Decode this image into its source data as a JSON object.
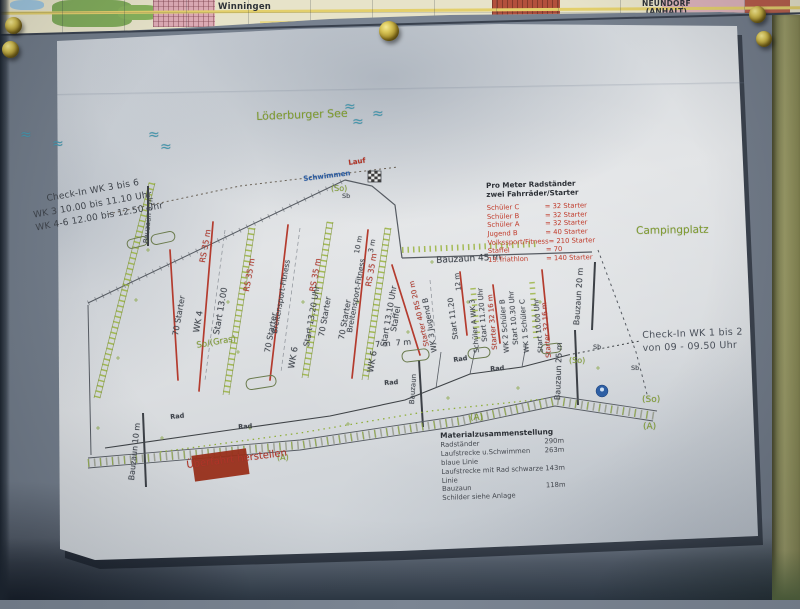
{
  "colors": {
    "dark": "#3f444b",
    "red": "#b23325",
    "green": "#7f9c2e",
    "blue": "#2e5fa4",
    "wave": "#4596ac",
    "paper": "#d6dade",
    "board": "#7b8593",
    "wood": "#9a9a66",
    "pin_gold": "#d8c456",
    "plan_line": "#565b62"
  },
  "background_map": {
    "town1": "Winningen",
    "town2_line1": "NEUNDORF",
    "town2_line2": "(ANHALT)"
  },
  "plan": {
    "checkin_left": [
      "Check-In WK 3 bis 6",
      "WK 3   10.00 bis 11.10 Uhr",
      "WK 4-6   12.00 bis 12.50 Uhr"
    ],
    "checkin_right": [
      "Check-In WK 1 bis 2",
      "von 09 - 09.50 Uhr"
    ],
    "legend": {
      "title1": "Pro Meter Radständer",
      "title2": "zwei Fahrräder/Starter",
      "rows": [
        {
          "label": "Schüler C",
          "value": "= 32 Starter"
        },
        {
          "label": "Schüler B",
          "value": "= 32 Starter"
        },
        {
          "label": "Schüler A",
          "value": "= 32 Starter"
        },
        {
          "label": "Jugend B",
          "value": "= 40 Starter"
        },
        {
          "label": "Volkssport/Fitness",
          "value": "= 210 Starter"
        },
        {
          "label": "Staffel",
          "value": "= 70"
        },
        {
          "label": "13.Triathlon",
          "value": "= 140 Starter"
        }
      ]
    },
    "materials": {
      "title": "Materialzusammenstellung",
      "rows": [
        {
          "label": "Radständer",
          "value": "290m"
        },
        {
          "label": "Laufstrecke u.Schwimmen blaue Linie",
          "value": "263m"
        },
        {
          "label": "Laufstrecke mit Rad schwarze Linie",
          "value": "143m"
        },
        {
          "label": "Bauzaun",
          "value": "118m"
        },
        {
          "label": "Schilder siehe Anlage",
          "value": ""
        }
      ]
    },
    "labels": [
      {
        "t": "Löderburger See",
        "x": 256,
        "y": 111,
        "r": -2,
        "c": "green",
        "s": 11,
        "n": "lake-label"
      },
      {
        "t": "Campingplatz",
        "x": 636,
        "y": 226,
        "r": -1,
        "c": "green",
        "s": 10.5,
        "n": "campsite-label"
      },
      {
        "t": "≈",
        "x": 20,
        "y": 128,
        "c": "wave",
        "s": 14,
        "n": "wave-icon"
      },
      {
        "t": "≈",
        "x": 52,
        "y": 137,
        "c": "wave",
        "s": 14,
        "n": "wave-icon"
      },
      {
        "t": "≈",
        "x": 148,
        "y": 128,
        "c": "wave",
        "s": 14,
        "n": "wave-icon"
      },
      {
        "t": "≈",
        "x": 160,
        "y": 140,
        "c": "wave",
        "s": 14,
        "n": "wave-icon"
      },
      {
        "t": "≈",
        "x": 344,
        "y": 100,
        "c": "wave",
        "s": 14,
        "n": "wave-icon"
      },
      {
        "t": "≈",
        "x": 372,
        "y": 107,
        "c": "wave",
        "s": 14,
        "n": "wave-icon"
      },
      {
        "t": "≈",
        "x": 352,
        "y": 115,
        "c": "wave",
        "s": 14,
        "n": "wave-icon"
      },
      {
        "t": "Lauf",
        "x": 348,
        "y": 160,
        "r": -8,
        "c": "red",
        "s": 7,
        "b": 1,
        "n": "route-label-lauf"
      },
      {
        "t": "Schwimmen",
        "x": 303,
        "y": 176,
        "r": -7,
        "c": "blue",
        "s": 7,
        "b": 1,
        "n": "route-label-schwimmen"
      },
      {
        "t": "(So)",
        "x": 331,
        "y": 185,
        "c": "green",
        "s": 8
      },
      {
        "t": "Sb",
        "x": 342,
        "y": 193,
        "c": "dark",
        "s": 6.5
      },
      {
        "t": "10 m",
        "x": 354,
        "y": 253,
        "r": -80,
        "c": "dark",
        "s": 7
      },
      {
        "t": "3 m",
        "x": 368,
        "y": 252,
        "r": -80,
        "c": "dark",
        "s": 7
      },
      {
        "t": "RS 35 m",
        "x": 199,
        "y": 262,
        "r": -80,
        "c": "red",
        "s": 8
      },
      {
        "t": "RS 35 m",
        "x": 243,
        "y": 291,
        "r": -80,
        "c": "red",
        "s": 8
      },
      {
        "t": "RS 35 m",
        "x": 309,
        "y": 291,
        "r": -80,
        "c": "red",
        "s": 8
      },
      {
        "t": "RS 35 m",
        "x": 365,
        "y": 286,
        "r": -80,
        "c": "red",
        "s": 8
      },
      {
        "t": "70 Starter",
        "x": 172,
        "y": 335,
        "r": -80,
        "c": "dark",
        "s": 8
      },
      {
        "t": "WK 4",
        "x": 193,
        "y": 332,
        "r": -80,
        "c": "dark",
        "s": 8.5
      },
      {
        "t": "Start 13.00",
        "x": 213,
        "y": 334,
        "r": -80,
        "c": "dark",
        "s": 8.5
      },
      {
        "t": "So/(Gras)",
        "x": 196,
        "y": 342,
        "r": -10,
        "c": "green",
        "s": 8.5
      },
      {
        "t": "70 Starter",
        "x": 264,
        "y": 352,
        "r": -80,
        "c": "dark",
        "s": 8
      },
      {
        "t": "Breitensport-Fitness",
        "x": 271,
        "y": 333,
        "r": -80,
        "c": "dark",
        "s": 7.5
      },
      {
        "t": "WK 6",
        "x": 288,
        "y": 368,
        "r": -80,
        "c": "dark",
        "s": 8.5
      },
      {
        "t": "Start 13.20 Uhr",
        "x": 303,
        "y": 346,
        "r": -80,
        "c": "dark",
        "s": 8
      },
      {
        "t": "70 Starter",
        "x": 318,
        "y": 336,
        "r": -80,
        "c": "dark",
        "s": 8
      },
      {
        "t": "70 Starter",
        "x": 338,
        "y": 339,
        "r": -80,
        "c": "dark",
        "s": 8
      },
      {
        "t": "Breitensport-Fitness",
        "x": 346,
        "y": 332,
        "r": -80,
        "c": "dark",
        "s": 7.5
      },
      {
        "t": "WK 6",
        "x": 367,
        "y": 372,
        "r": -80,
        "c": "dark",
        "s": 8.5
      },
      {
        "t": "Start 13.10 Uhr",
        "x": 380,
        "y": 346,
        "r": -80,
        "c": "dark",
        "s": 8
      },
      {
        "t": "Staffel",
        "x": 390,
        "y": 331,
        "r": -80,
        "c": "dark",
        "s": 8
      },
      {
        "t": "Starter 40 RS 20 m",
        "x": 424,
        "y": 347,
        "r": -103,
        "c": "red",
        "s": 7
      },
      {
        "t": "WK 3 Jugend B",
        "x": 431,
        "y": 353,
        "r": -100,
        "c": "dark",
        "s": 7.5
      },
      {
        "t": "Start 11.20",
        "x": 452,
        "y": 340,
        "r": -97,
        "c": "dark",
        "s": 7.5
      },
      {
        "t": "12 m",
        "x": 456,
        "y": 291,
        "r": -97,
        "c": "dark",
        "s": 7
      },
      {
        "t": "Schüler A WK 3",
        "x": 474,
        "y": 353,
        "r": -95,
        "c": "dark",
        "s": 7
      },
      {
        "t": "Start 11.20 Uhr",
        "x": 482,
        "y": 342,
        "r": -95,
        "c": "dark",
        "s": 7
      },
      {
        "t": "Starter 32 16 m",
        "x": 492,
        "y": 350,
        "r": -95,
        "c": "red",
        "s": 7
      },
      {
        "t": "WK 2 Schüler B",
        "x": 504,
        "y": 353,
        "r": -95,
        "c": "dark",
        "s": 7
      },
      {
        "t": "Start 10.30 Uhr",
        "x": 513,
        "y": 345,
        "r": -95,
        "c": "dark",
        "s": 7
      },
      {
        "t": "WK 1 Schüler C",
        "x": 524,
        "y": 353,
        "r": -95,
        "c": "dark",
        "s": 7
      },
      {
        "t": "Start 10.00 Uhr",
        "x": 538,
        "y": 353,
        "r": -95,
        "c": "dark",
        "s": 7
      },
      {
        "t": "Starter 32 16 m",
        "x": 546,
        "y": 358,
        "r": -95,
        "c": "red",
        "s": 7
      },
      {
        "t": "Bauzaun 45 m",
        "x": 436,
        "y": 257,
        "r": -3,
        "c": "dark",
        "s": 9,
        "n": "bauzaun-45-label"
      },
      {
        "t": "Bauzaun 20 m",
        "x": 573,
        "y": 325,
        "r": -86,
        "c": "dark",
        "s": 8
      },
      {
        "t": "Bauzaun 25 m",
        "x": 554,
        "y": 400,
        "r": -88,
        "c": "dark",
        "s": 8
      },
      {
        "t": "Bauzaun",
        "x": 409,
        "y": 404,
        "r": -86,
        "c": "dark",
        "s": 7
      },
      {
        "t": "Bauzaun 10 m",
        "x": 128,
        "y": 480,
        "r": -84,
        "c": "dark",
        "s": 8
      },
      {
        "t": "Bauzaun 9 m",
        "x": 143,
        "y": 243,
        "r": -84,
        "c": "dark",
        "s": 7
      },
      {
        "t": "7 m  7 m",
        "x": 375,
        "y": 341,
        "r": -4,
        "c": "dark",
        "s": 8
      },
      {
        "t": "Rad",
        "x": 170,
        "y": 414,
        "r": -6,
        "c": "dark",
        "s": 6.5,
        "b": 1
      },
      {
        "t": "Rad",
        "x": 238,
        "y": 424,
        "r": -4,
        "c": "dark",
        "s": 6.5,
        "b": 1
      },
      {
        "t": "Rad",
        "x": 384,
        "y": 380,
        "r": -4,
        "c": "dark",
        "s": 6.5,
        "b": 1
      },
      {
        "t": "Rad",
        "x": 453,
        "y": 357,
        "r": -8,
        "c": "dark",
        "s": 6.5,
        "b": 1
      },
      {
        "t": "Rad",
        "x": 490,
        "y": 366,
        "r": -4,
        "c": "dark",
        "s": 6.5,
        "b": 1
      },
      {
        "t": "(So)",
        "x": 569,
        "y": 357,
        "c": "green",
        "s": 8
      },
      {
        "t": "Sb",
        "x": 593,
        "y": 344,
        "c": "dark",
        "s": 6.5
      },
      {
        "t": "Sb",
        "x": 631,
        "y": 365,
        "c": "dark",
        "s": 6.5
      },
      {
        "t": "(So)",
        "x": 642,
        "y": 396,
        "c": "green",
        "s": 9
      },
      {
        "t": "(A)",
        "x": 277,
        "y": 454,
        "c": "green",
        "s": 8
      },
      {
        "t": "(A)",
        "x": 470,
        "y": 414,
        "c": "green",
        "s": 9
      },
      {
        "t": "(A)",
        "x": 643,
        "y": 423,
        "c": "green",
        "s": 9
      },
      {
        "t": "Überfahrt herstellen",
        "x": 186,
        "y": 461,
        "r": -7,
        "c": "red",
        "s": 10,
        "n": "ueberfahrt-label"
      }
    ]
  }
}
